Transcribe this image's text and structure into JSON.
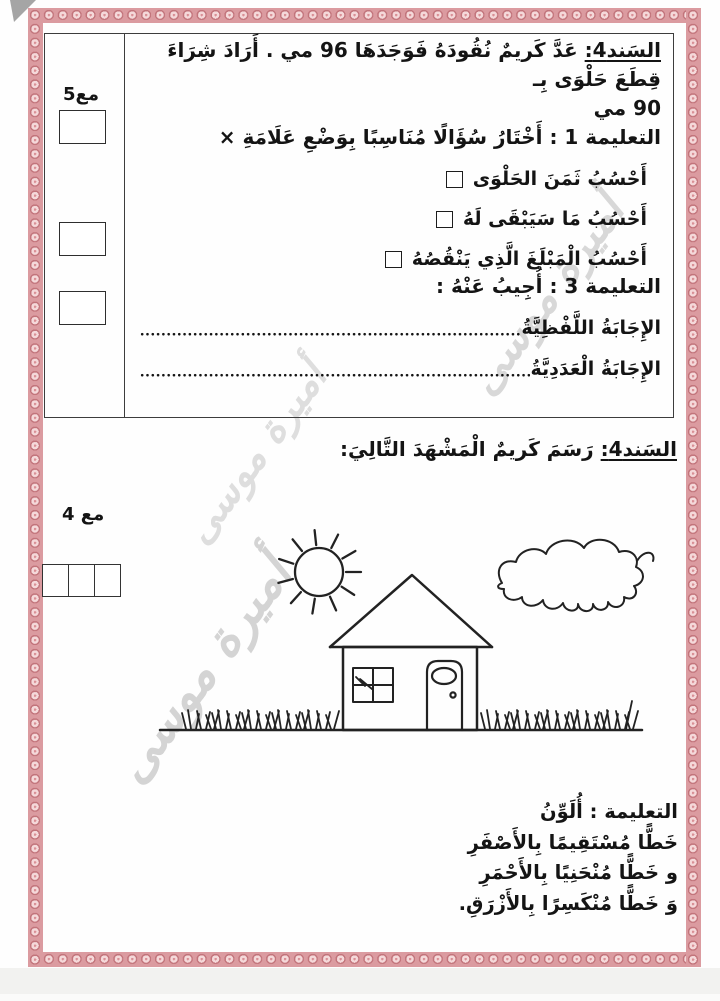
{
  "watermark": {
    "text": "أميرة موسى"
  },
  "colors": {
    "border_band": "#db9ba0",
    "rosette_fill": "#f5d9da",
    "rosette_ring": "#c2747b",
    "ink": "#141414"
  },
  "section1": {
    "score_label": "مع5",
    "title": "السَند4:",
    "intro_line1": "عَدَّ كَريمٌ نُقُودَهُ فَوَجَدَهَا 96 مي . أَرَادَ شِرَاءَ قِطَعَ حَلْوَى بِـ",
    "intro_line2": "90 مي",
    "instruction1": "التعليمة 1 :  أَخْتَارُ سُؤَالًا مُنَاسِبًا بِوَضْعِ عَلَامَةِ ×",
    "options": [
      {
        "label": "أَحْسُبُ ثَمَنَ الحَلْوَى"
      },
      {
        "label": "أَحْسُبُ مَا سَيَبْقَى لَهُ"
      },
      {
        "label": "أَحْسُبُ الْمَبْلَغَ الَّذِي يَنْقُصُهُ"
      }
    ],
    "instruction3": "التعليمة 3 : أُجِيبُ عَنْهُ :",
    "answer_rows": [
      {
        "label": "الإِجَابَةُ اللَّفْظِيَّةُ"
      },
      {
        "label": "الإِجَابَةُ الْعَدَدِيَّةُ"
      }
    ]
  },
  "section2": {
    "title": "السَند4:",
    "intro": "رَسَمَ كَريمٌ الْمَشْهَدَ التَّالِيَ:",
    "score_label": "مع 4",
    "scene_items": [
      "sun",
      "cloud",
      "house",
      "window",
      "door",
      "grass"
    ],
    "coloring": {
      "title": "التعليمة : أُلَوِّنُ",
      "lines": [
        "خَطًّا مُسْتَقِيمًا  بِالأَصْفَرِ",
        "و خَطًّا مُنْحَنِيًا بِالأَحْمَرِ",
        "وَ خَطًّا مُنْكَسِرًا بِالأَزْرَقِ."
      ]
    }
  }
}
